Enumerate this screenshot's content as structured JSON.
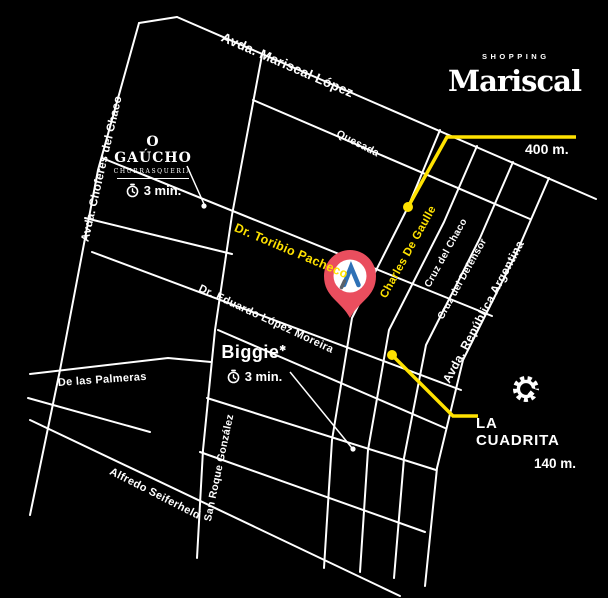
{
  "colors": {
    "background": "#000000",
    "street": "#ffffff",
    "accent_yellow": "#FFE200",
    "pin_red": "#EA4E5E",
    "pin_glyph_blue": "#2E71B6"
  },
  "streets": {
    "mariscal_lopez": "Avda. Mariscal López",
    "choferes_del_chaco": "Avda. Choferes del Chaco",
    "quesada": "Quesada",
    "toribio_pacheco": "Dr. Toribio Pacheco",
    "eduardo_lopez_moreira": "Dr. Eduardo López Moreira",
    "charles_de_gaulle": "Charles De Gaulle",
    "cruz_del_chaco": "Cruz del Chaco",
    "cruz_del_defensor": "Cruz del Defensor",
    "republica_argentina": "Avda. República Argentina",
    "san_roque_gonzalez": "San Roque González",
    "alfredo_seiferheld": "Alfredo Seiferheld",
    "de_las_palmeras": "De las Palmeras"
  },
  "pois": {
    "o_gaucho": {
      "name": "O GAÚCHO",
      "subtitle": "CHURRASQUERIA",
      "time": "3 min.",
      "icon": "clock-icon"
    },
    "biggie": {
      "name": "Biggie",
      "time": "3 min.",
      "icon": "clock-icon"
    },
    "shopping_mariscal": {
      "brand_top": "SHOPPING",
      "brand": "Mariscal",
      "distance": "400 m."
    },
    "la_cuadrita": {
      "name": "LA CUADRITA",
      "distance": "140 m.",
      "icon": "gear-c-icon"
    }
  },
  "marker": {
    "type": "location-pin",
    "glyph": "A"
  }
}
